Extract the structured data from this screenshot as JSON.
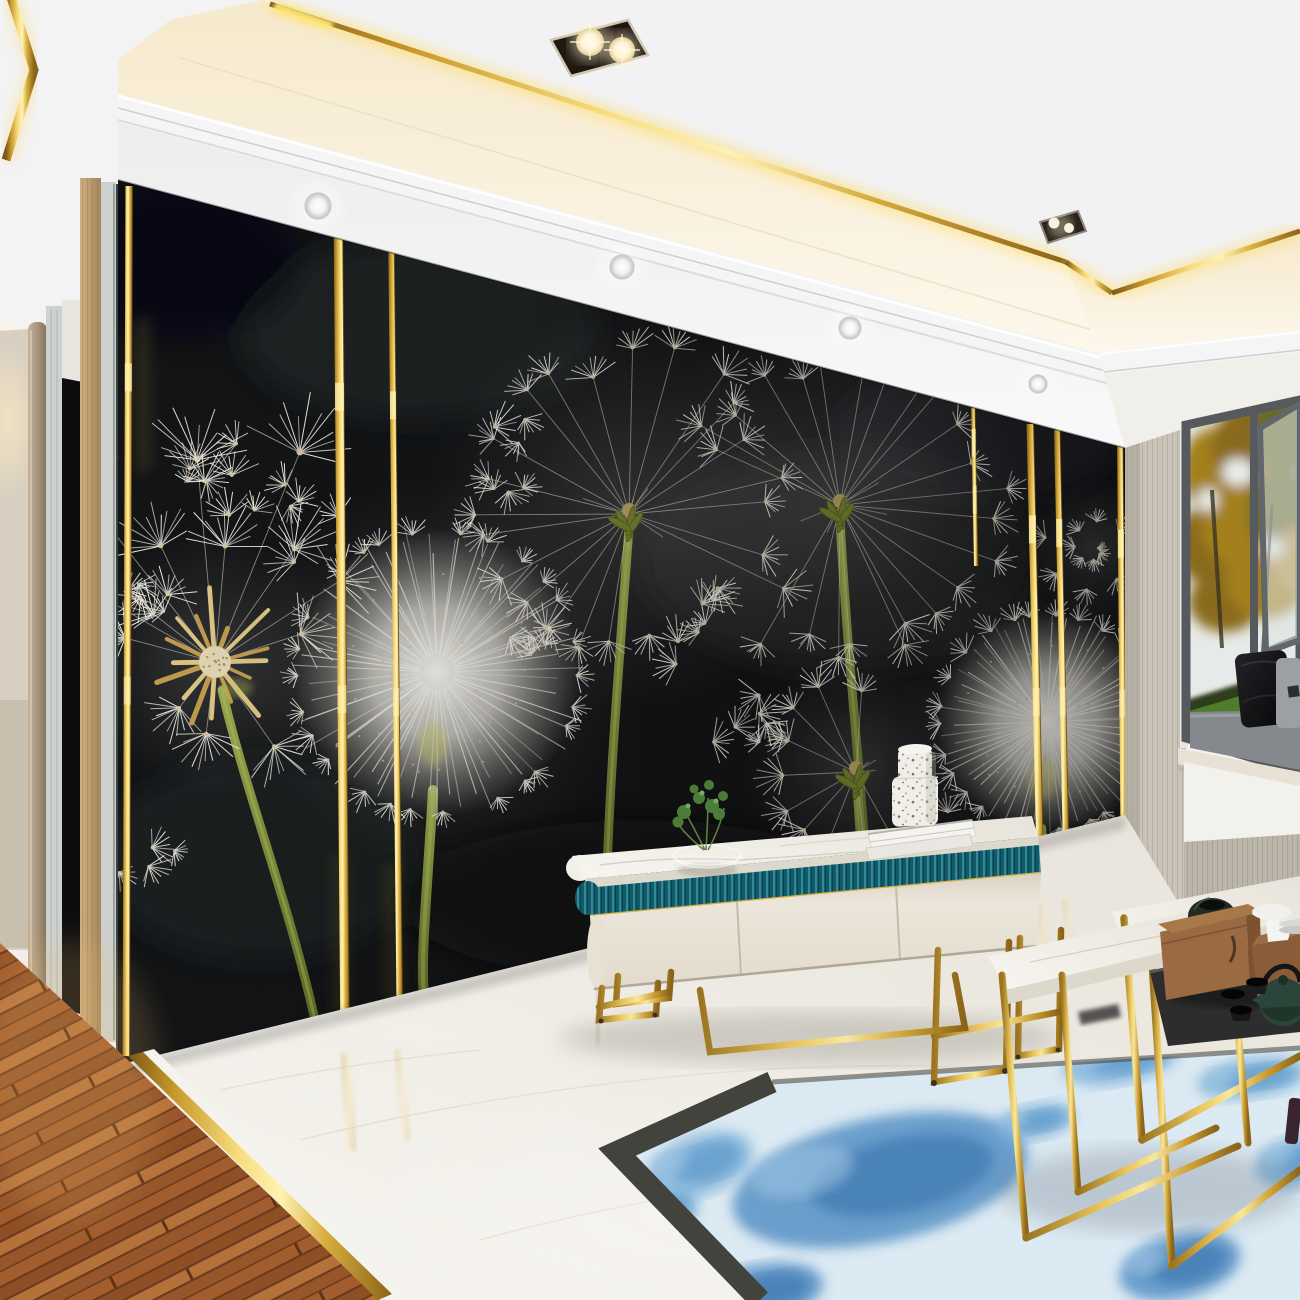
{
  "palette": {
    "ceiling": "#f3f3f4",
    "cove": "#f7ecd2",
    "cove2": "#fdf8ec",
    "molding": "#f5f5f6",
    "soffit": "#ececee",
    "wall_black": "#141517",
    "wall_mottle": "#303136",
    "gold": "#d9ad3c",
    "gold_hi": "#fff2b2",
    "gold_deep": "#8a6418",
    "beige": "#cac4b8",
    "pier": "#b9b3a7",
    "hall_wall": "#d8cfc1",
    "door_dark": "#0d0d0f",
    "wood_col": "#a8957f",
    "curtain": "#cdd2d1",
    "tan_panel": "#c8a87c",
    "gray_panel": "#ccd0cf",
    "sliver": "#39453c",
    "marble": "#f0ede6",
    "marble_lo": "#ddd8cc",
    "wood_a": "#a25c2d",
    "wood_b": "#8e4f26",
    "wood_seam": "#6b3a1c",
    "teal_a": "#135a68",
    "teal_b": "#2f8b9b",
    "cream": "#eae4d8",
    "stem_a": "#99a84c",
    "stem_b": "#5f6e28",
    "seed": "#f3f1e8",
    "seed_dot": "#d9c9a0",
    "spike": "#c9a352",
    "rug_field": "#d9e8f2",
    "rug_blue": "#7fb2d9",
    "rug_blue2": "#4f8cc2",
    "rug_border": "#42433c",
    "lawn": "#4f7d2e",
    "shrub": "#2f3d1f",
    "sky": "#e6eae8",
    "foliage_a": "#a3801f",
    "foliage_b": "#8a6a1e",
    "foliage_c": "#6b6b2a",
    "frame": "#565a5e",
    "seat": "#85898d",
    "pillow_black": "#121214",
    "pillow_gray": "#9aa0a4",
    "sill": "#e8e2d6",
    "under_panel": "#f3f1ec",
    "tray": "#2d2d2d",
    "wood_box": "#9a6a42",
    "wood_box2": "#7c5230",
    "teapot": "#2b453a",
    "cup": "#1d1d1d",
    "cloth": "#f1f0ec",
    "terrazzo": "#f0eee7"
  },
  "scene": {
    "wall_poly": "118,180 1125,448 1125,815 118,1072",
    "strips": [
      {
        "x1": 129,
        "y1": 186,
        "x2": 126,
        "y2": 1056,
        "w": 7
      },
      {
        "x1": 338,
        "y1": 212,
        "x2": 345,
        "y2": 1052,
        "w": 9
      },
      {
        "x1": 391,
        "y1": 224,
        "x2": 400,
        "y2": 1048,
        "w": 6
      },
      {
        "x1": 973,
        "y1": 408,
        "x2": 976,
        "y2": 566,
        "w": 4
      },
      {
        "x1": 1030,
        "y1": 424,
        "x2": 1041,
        "y2": 903,
        "w": 7
      },
      {
        "x1": 1057,
        "y1": 430,
        "x2": 1067,
        "y2": 898,
        "w": 6
      },
      {
        "x1": 1120,
        "y1": 446,
        "x2": 1124,
        "y2": 890,
        "w": 6
      }
    ],
    "dandelions": [
      {
        "kind": "bare",
        "cx": 215,
        "cy": 662,
        "r": 100,
        "seed": 3,
        "stem": "M222,690 C245,790 288,900 315,1020",
        "stem_w": 9,
        "tufts": [
          [
            -128,
            215
          ],
          [
            -95,
            205
          ],
          [
            -68,
            228
          ],
          [
            -150,
            150
          ],
          [
            -115,
            130
          ],
          [
            -85,
            118
          ],
          [
            -55,
            140
          ],
          [
            -33,
            150
          ],
          [
            -165,
            95
          ],
          [
            -142,
            80
          ],
          [
            -18,
            92
          ],
          [
            97,
            74
          ],
          [
            128,
            60
          ],
          [
            55,
            105
          ]
        ]
      },
      {
        "kind": "puff",
        "cx": 437,
        "cy": 672,
        "r": 146,
        "seed": 5,
        "stem": "M433,790 C428,880 420,960 424,994",
        "stem_w": 10
      },
      {
        "kind": "ring",
        "cx": 629,
        "cy": 508,
        "r": 152,
        "seed": 7,
        "head": [
          629,
          514
        ],
        "a0": 95,
        "a1": 388,
        "n": 21,
        "stem": "M629,528 C616,700 608,810 606,905",
        "stem_w": 9
      },
      {
        "kind": "ring",
        "cx": 840,
        "cy": 497,
        "r": 150,
        "seed": 11,
        "head": [
          840,
          505
        ],
        "a0": -160,
        "a1": 120,
        "n": 23,
        "stem": "M840,520 C847,650 860,770 866,862",
        "stem_w": 9
      },
      {
        "kind": "ring",
        "cx": 856,
        "cy": 768,
        "r": 84,
        "seed": 13,
        "head": [
          856,
          772
        ],
        "a0": 60,
        "a1": 270,
        "n": 10,
        "stem": "M856,784 C858,820 860,845 862,866",
        "stem_w": 7
      },
      {
        "kind": "puff",
        "cx": 1047,
        "cy": 722,
        "r": 112,
        "seed": 17,
        "stem": "M1042,828 C1050,900 1060,950 1066,830",
        "stem_w": 8
      },
      {
        "kind": "swirl",
        "cx": 1094,
        "cy": 548,
        "r": 52,
        "seed": 19
      }
    ],
    "tuft_clusters": [
      {
        "x": 200,
        "y": 470,
        "n": 7,
        "s": 55,
        "seed": 21
      },
      {
        "x": 292,
        "y": 522,
        "n": 6,
        "s": 48,
        "seed": 22
      },
      {
        "x": 160,
        "y": 600,
        "n": 5,
        "s": 40,
        "seed": 23
      },
      {
        "x": 152,
        "y": 860,
        "n": 4,
        "s": 46,
        "seed": 24
      },
      {
        "x": 522,
        "y": 458,
        "n": 6,
        "s": 42,
        "seed": 25
      },
      {
        "x": 700,
        "y": 620,
        "n": 8,
        "s": 55,
        "seed": 26
      },
      {
        "x": 756,
        "y": 722,
        "n": 7,
        "s": 46,
        "seed": 27
      },
      {
        "x": 545,
        "y": 642,
        "n": 5,
        "s": 40,
        "seed": 28
      },
      {
        "x": 948,
        "y": 842,
        "n": 4,
        "s": 34,
        "seed": 29
      }
    ],
    "downlights": [
      [
        318,
        206,
        13
      ],
      [
        622,
        267,
        12
      ],
      [
        850,
        328,
        11
      ],
      [
        1038,
        384,
        9
      ]
    ],
    "rug_blobs": [
      {
        "cx": 880,
        "cy": 1180,
        "rx": 150,
        "ry": 62,
        "rot": -12,
        "deep": true
      },
      {
        "cx": 700,
        "cy": 1165,
        "rx": 55,
        "ry": 30,
        "rot": -20,
        "deep": false
      },
      {
        "cx": 660,
        "cy": 1212,
        "rx": 40,
        "ry": 22,
        "rot": -15,
        "deep": false
      },
      {
        "cx": 762,
        "cy": 1292,
        "rx": 62,
        "ry": 28,
        "rot": -10,
        "deep": true
      },
      {
        "cx": 1120,
        "cy": 1062,
        "rx": 58,
        "ry": 22,
        "rot": -10,
        "deep": false
      },
      {
        "cx": 1252,
        "cy": 1078,
        "rx": 55,
        "ry": 20,
        "rot": -8,
        "deep": false
      },
      {
        "cx": 1180,
        "cy": 1266,
        "rx": 62,
        "ry": 32,
        "rot": -14,
        "deep": true
      },
      {
        "cx": 1300,
        "cy": 1162,
        "rx": 45,
        "ry": 26,
        "rot": -10,
        "deep": false
      },
      {
        "cx": 1035,
        "cy": 1122,
        "rx": 40,
        "ry": 18,
        "rot": -12,
        "deep": false
      }
    ]
  }
}
